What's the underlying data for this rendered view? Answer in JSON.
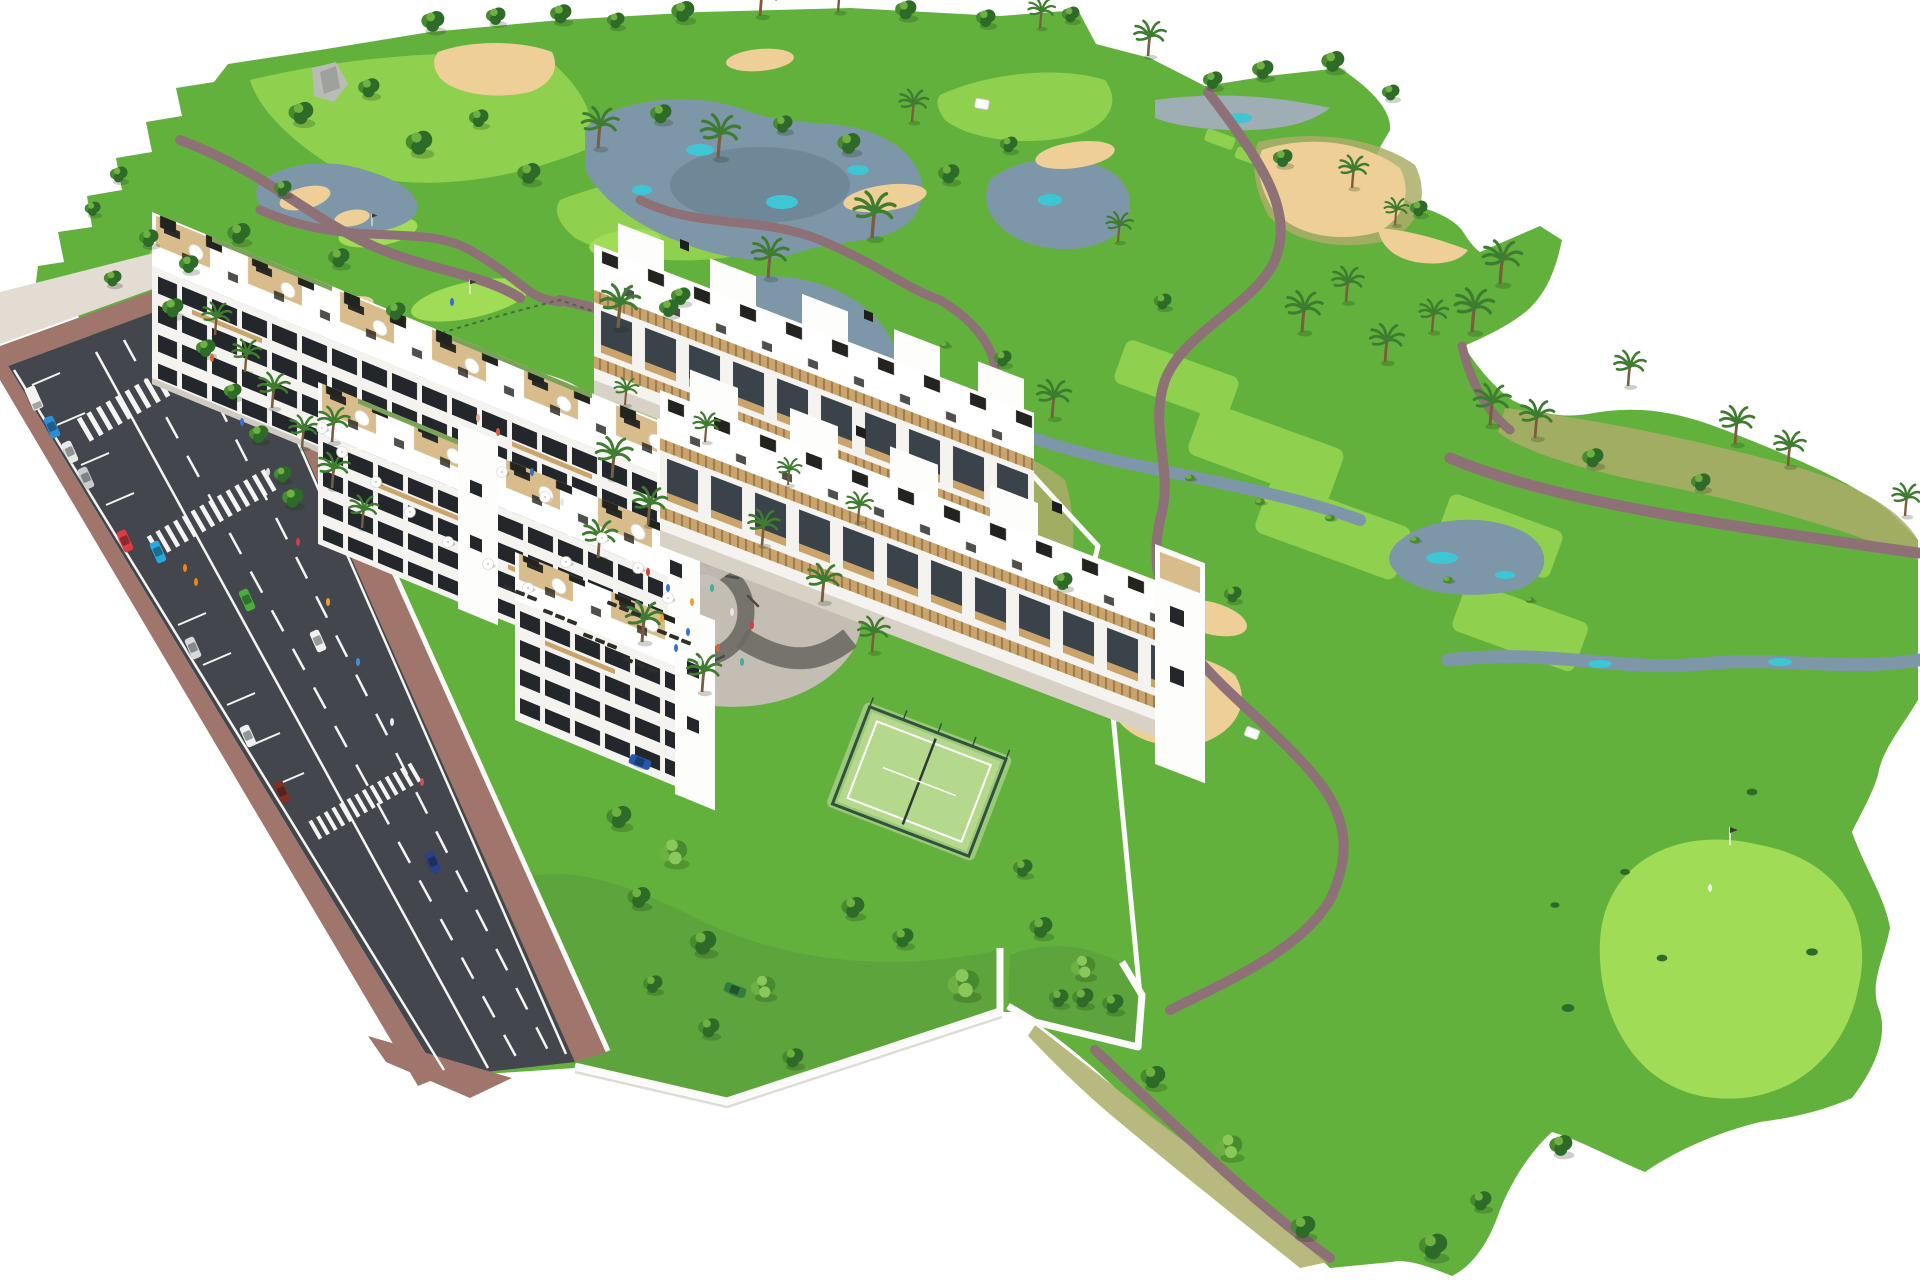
{
  "meta": {
    "title": "Aerial 3D rendering of a white apartment complex beside a golf course",
    "type": "3D architectural aerial rendering (no text in image)",
    "canvas": {
      "width": 1920,
      "height": 1280
    },
    "background": "#FFFFFF"
  },
  "scene": {
    "description": "Bird's-eye computer rendering: two long white apartment slabs with rooftop terraces along a diagonal road with parked and moving cars, two terraced apartment rows around a central plaza with outdoor-gym playground and a fenced padel court, a communal pool lawn with white parasols and sun loungers, walled private gardens, and a large golf course with irrigation lakes, teal shallows, sand bunkers, mauve cart paths, palm trees, putting greens with flags and a golf buggy.",
    "palette": {
      "grass": "#62B13D",
      "grassGarden": "#5EA43C",
      "fairway": "#8FD14E",
      "greenBright": "#A0DC55",
      "roughOlive": "#ABAD69",
      "sand": "#EDCF97",
      "sandLight": "#F4E0B4",
      "water": "#7E97A8",
      "waterDark": "#5A7585",
      "waterTeal": "#3EC6D4",
      "waterGray": "#9FADB5",
      "path": "#8E7077",
      "road": "#43474D",
      "marking": "#F4F4F2",
      "brick": "#A0766C",
      "concrete": "#E2DCD2",
      "facade": "#F5F3EF",
      "window": "#23272B",
      "opening": "#3A424A",
      "wood": "#CBA46B",
      "roofDeck": "#D9BC8C",
      "roofWhite": "#FFFFFF",
      "greenRoof": "#79A457",
      "poolWater": "#7FC2DD",
      "poolDeck": "#EBE5DA",
      "padelTurf": "#B4D98C",
      "padelFence": "#33523D",
      "playPave": "#C3BDB4",
      "playPath": "#6E6A64",
      "wallWhite": "#FBFBF9",
      "treeDark": "#2F6B28",
      "treeMid": "#478A30",
      "treeLight": "#6FB043",
      "palmGreen": "#3E7C2F",
      "rock": "#B9BBB5"
    },
    "features": [
      {
        "id": "golf-course",
        "label": "Golf course with fairways and greens"
      },
      {
        "id": "lakes",
        "label": "Irrigation lakes and streams with teal shallows"
      },
      {
        "id": "sand-bunkers",
        "label": "Sand bunkers and waste areas"
      },
      {
        "id": "cart-paths",
        "label": "Mauve golf cart paths"
      },
      {
        "id": "apartment-slabs",
        "label": "Three staggered white apartment slabs along the road"
      },
      {
        "id": "terraced-rows",
        "label": "Two terraced apartment rows with pergola terraces"
      },
      {
        "id": "rooftop-terraces",
        "label": "Roof terraces with wood decks, parasols and furniture"
      },
      {
        "id": "communal-pool",
        "label": "Communal swimming pool with parasols and sun loungers"
      },
      {
        "id": "putting-green",
        "label": "Putting green with flag next to the pool lawn"
      },
      {
        "id": "playground-plaza",
        "label": "Central plaza with playground / outdoor gym"
      },
      {
        "id": "padel-court",
        "label": "Fenced padel court"
      },
      {
        "id": "walled-gardens",
        "label": "Walled private gardens with dense trees"
      },
      {
        "id": "access-road",
        "label": "Two-lane road with street parking and crosswalks"
      },
      {
        "id": "golf-green-flag",
        "label": "Large golf green with flag and golfer at lower right"
      }
    ],
    "road": {
      "lanes": 2,
      "surface_markings": [
        "solid edge lines",
        "dashed lane lines",
        "parking bay ticks"
      ],
      "crosswalks": 3
    },
    "vehicles": {
      "street": [
        {
          "type": "van",
          "state": "parked",
          "color": "#F2F2F0"
        },
        {
          "type": "car",
          "state": "parked",
          "color": "#2B8FD8"
        },
        {
          "type": "car",
          "state": "parked",
          "color": "#E8E8E6"
        },
        {
          "type": "car",
          "state": "parked",
          "color": "#C9CCCE"
        },
        {
          "type": "car",
          "state": "driving",
          "color": "#E03A44"
        },
        {
          "type": "car",
          "state": "driving",
          "color": "#29A7E0"
        },
        {
          "type": "car",
          "state": "driving",
          "color": "#F0F0EE"
        },
        {
          "type": "car",
          "state": "parked",
          "color": "#D7D9DB"
        },
        {
          "type": "car",
          "state": "driving",
          "color": "#49AE3C"
        },
        {
          "type": "car",
          "state": "parked",
          "color": "#EDEFF0"
        },
        {
          "type": "car",
          "state": "parked",
          "color": "#7E2F26"
        },
        {
          "type": "car",
          "state": "driving",
          "color": "#2C3F8C"
        }
      ],
      "complex": [
        {
          "type": "car",
          "state": "parked",
          "color": "#2F7E3F"
        },
        {
          "type": "car",
          "state": "parked",
          "color": "#2458B0"
        }
      ],
      "golf_carts": [
        {
          "type": "golf-cart",
          "color": "#F6F6F4"
        },
        {
          "type": "golf-cart",
          "color": "#F6F6F4"
        }
      ]
    },
    "amenities": {
      "swimming_pool": 1,
      "pool_umbrellas": 13,
      "sun_loungers": 18,
      "padel_courts": 1,
      "playgrounds": 1,
      "golf_flags": 2,
      "golfers_visible": 2
    }
  }
}
